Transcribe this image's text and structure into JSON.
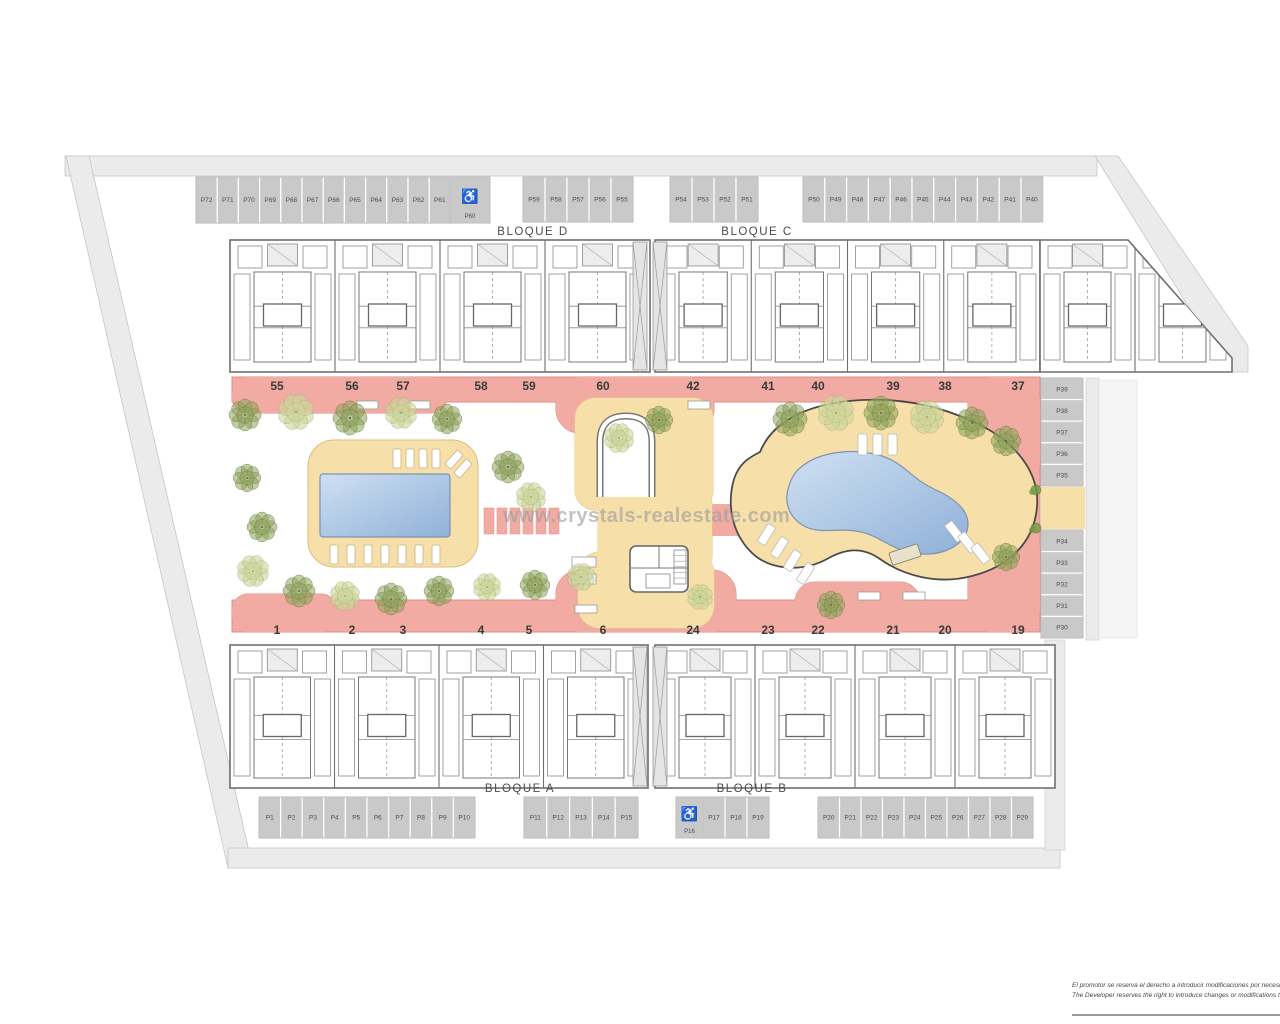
{
  "watermark": {
    "text": "www.crystals-realestate.com"
  },
  "blocks": {
    "bloque_d": "BLOQUE D",
    "bloque_c": "BLOQUE C",
    "bloque_a": "BLOQUE A",
    "bloque_b": "BLOQUE B"
  },
  "parking_groups": [
    {
      "id": "top-left",
      "labels": [
        "P72",
        "P71",
        "P70",
        "P69",
        "P68",
        "P67",
        "P66",
        "P65",
        "P64",
        "P63",
        "P62",
        "P61"
      ]
    },
    {
      "id": "top-left-acc",
      "labels": [
        "P60"
      ],
      "accessible": true
    },
    {
      "id": "top-mid-d",
      "labels": [
        "P59",
        "P58",
        "P57",
        "P56",
        "P55"
      ]
    },
    {
      "id": "top-mid-c",
      "labels": [
        "P54",
        "P53",
        "P52",
        "P51"
      ]
    },
    {
      "id": "top-right",
      "labels": [
        "P50",
        "P49",
        "P48",
        "P47",
        "P46",
        "P45",
        "P44",
        "P43",
        "P42",
        "P41",
        "P40"
      ]
    },
    {
      "id": "right-upper",
      "labels": [
        "P39",
        "P38",
        "P37",
        "P36",
        "P35"
      ]
    },
    {
      "id": "right-lower",
      "labels": [
        "P34",
        "P33",
        "P32",
        "P31",
        "P30"
      ]
    },
    {
      "id": "bottom-left",
      "labels": [
        "P1",
        "P2",
        "P3",
        "P4",
        "P5",
        "P6",
        "P7",
        "P8",
        "P9",
        "P10"
      ]
    },
    {
      "id": "bottom-mid-a",
      "labels": [
        "P11",
        "P12",
        "P13",
        "P14",
        "P15"
      ]
    },
    {
      "id": "bottom-acc",
      "labels": [
        "P16"
      ],
      "accessible": true
    },
    {
      "id": "bottom-mid-b",
      "labels": [
        "P17",
        "P18",
        "P19"
      ]
    },
    {
      "id": "bottom-right",
      "labels": [
        "P20",
        "P21",
        "P22",
        "P23",
        "P24",
        "P25",
        "P26",
        "P27",
        "P28",
        "P29"
      ]
    }
  ],
  "accessible_icon": "♿",
  "unit_numbers": {
    "top_left": [
      "55",
      "56",
      "57",
      "58",
      "59",
      "60"
    ],
    "top_right": [
      "42",
      "41",
      "40",
      "39",
      "38",
      "37"
    ],
    "bottom_left": [
      "1",
      "2",
      "3",
      "4",
      "5",
      "6"
    ],
    "bottom_right": [
      "24",
      "23",
      "22",
      "21",
      "20",
      "19"
    ]
  },
  "disclaimer": {
    "line1": "El promotor se reserva el derecho a introducir modificaciones por necesid",
    "line2": "The Developer reserves the right to introduce changes or modifications to"
  },
  "colors": {
    "road_gray": "#ebebeb",
    "road_stroke": "#c6c6c6",
    "parking_gray": "#c9c9c9",
    "pad_stroke": "#b0b0b0",
    "wall_gray": "#6f6f6f",
    "inner_wall": "#8a8a8a",
    "label_gray": "#4a4a4a",
    "path_pink": "#f2aba3",
    "path_pink_stroke": "#df8e86",
    "deck_tan": "#f7dfa9",
    "deck_tan_stroke": "#e6c98e",
    "deck_outline_dark": "#4a4a4a",
    "pool_light": "#cfe0f2",
    "pool_dark": "#8fb0d8",
    "pool_stroke": "#7d93b0",
    "tree_dark_fill": "#8fa35c",
    "tree_dark_stroke": "#55702e",
    "tree_light_fill": "#cdd69b",
    "tree_light_stroke": "#9aa765",
    "bush_green": "#6f9c44",
    "number_gray": "#3a3a3a"
  }
}
